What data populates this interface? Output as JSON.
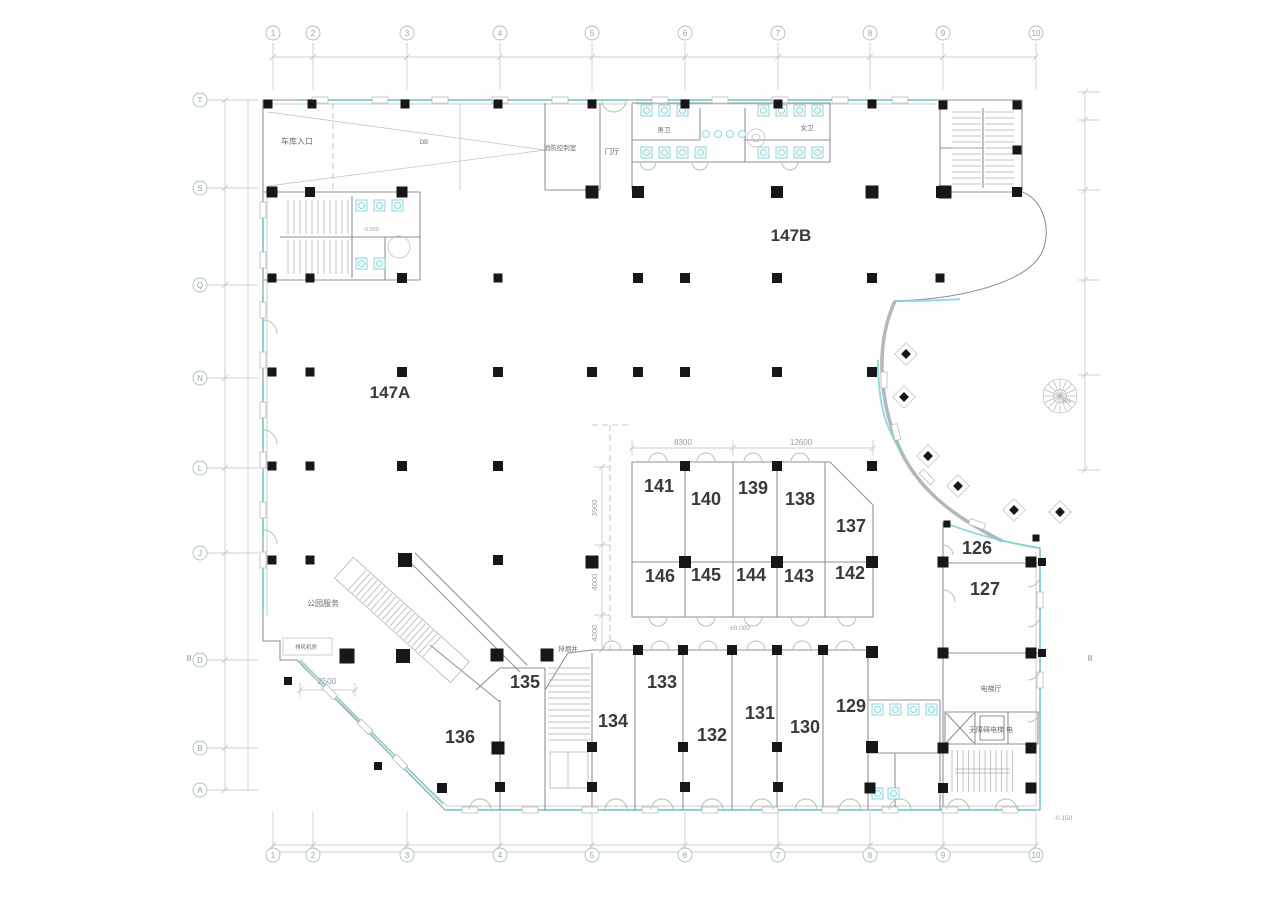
{
  "colors": {
    "glazing": "#85d3d6",
    "door_arc": "#abccab",
    "column": "#17171a",
    "wall": "#8e939a",
    "dim": "#9aa1a7",
    "room_text": "#3a3a3e",
    "label_text": "#6b6f73",
    "grid_text": "#8fa79a"
  },
  "halls": [
    {
      "label": "147A",
      "x": 390,
      "y": 398
    },
    {
      "label": "147B",
      "x": 791,
      "y": 241
    }
  ],
  "rooms": [
    {
      "label": "141",
      "x": 659,
      "y": 492
    },
    {
      "label": "140",
      "x": 706,
      "y": 505
    },
    {
      "label": "139",
      "x": 753,
      "y": 494
    },
    {
      "label": "138",
      "x": 800,
      "y": 505
    },
    {
      "label": "137",
      "x": 851,
      "y": 532
    },
    {
      "label": "146",
      "x": 660,
      "y": 582
    },
    {
      "label": "145",
      "x": 706,
      "y": 581
    },
    {
      "label": "144",
      "x": 751,
      "y": 581
    },
    {
      "label": "143",
      "x": 799,
      "y": 582
    },
    {
      "label": "142",
      "x": 850,
      "y": 579
    },
    {
      "label": "126",
      "x": 977,
      "y": 554
    },
    {
      "label": "127",
      "x": 985,
      "y": 595
    },
    {
      "label": "136",
      "x": 460,
      "y": 743
    },
    {
      "label": "135",
      "x": 525,
      "y": 688
    },
    {
      "label": "134",
      "x": 613,
      "y": 727
    },
    {
      "label": "133",
      "x": 662,
      "y": 688
    },
    {
      "label": "132",
      "x": 712,
      "y": 741
    },
    {
      "label": "131",
      "x": 760,
      "y": 719
    },
    {
      "label": "130",
      "x": 805,
      "y": 733
    },
    {
      "label": "129",
      "x": 851,
      "y": 712
    }
  ],
  "labels": [
    {
      "text": "车库入口",
      "x": 297,
      "y": 144,
      "s": 8
    },
    {
      "text": "DB",
      "x": 424,
      "y": 144,
      "s": 6
    },
    {
      "text": "消防控制室",
      "x": 560,
      "y": 150,
      "s": 6.5
    },
    {
      "text": "门厅",
      "x": 612,
      "y": 154,
      "s": 7.5
    },
    {
      "text": "男卫",
      "x": 664,
      "y": 132,
      "s": 6.5
    },
    {
      "text": "女卫",
      "x": 807,
      "y": 130,
      "s": 6.5
    },
    {
      "text": "公园服务",
      "x": 323,
      "y": 606,
      "s": 8
    },
    {
      "text": "排风机房",
      "x": 306,
      "y": 649,
      "s": 5.5
    },
    {
      "text": "排烟井",
      "x": 568,
      "y": 651,
      "s": 6.5
    },
    {
      "text": "电梯厅",
      "x": 991,
      "y": 691,
      "s": 7
    },
    {
      "text": "无障碍电梯 电",
      "x": 991,
      "y": 732,
      "s": 7
    }
  ],
  "dimensions": [
    {
      "text": "8300",
      "x": 683,
      "y": 445,
      "s": 8
    },
    {
      "text": "12600",
      "x": 801,
      "y": 445,
      "s": 8
    },
    {
      "text": "3900",
      "x": 597,
      "y": 508,
      "s": 7.5,
      "r": -90
    },
    {
      "text": "4000",
      "x": 597,
      "y": 582,
      "s": 7.5,
      "r": -90
    },
    {
      "text": "4200",
      "x": 597,
      "y": 633,
      "s": 7.5,
      "r": -90
    },
    {
      "text": "2500",
      "x": 327,
      "y": 684,
      "s": 8.5
    }
  ],
  "elevations": [
    {
      "text": "±0.000",
      "x": 740,
      "y": 630,
      "s": 6.5
    },
    {
      "text": "-0.150",
      "x": 1063,
      "y": 820,
      "s": 6.5
    },
    {
      "text": "-0.030",
      "x": 371,
      "y": 231,
      "s": 5.5
    },
    {
      "text": "5%",
      "x": 1067,
      "y": 403,
      "s": 6
    }
  ],
  "section_markers": [
    {
      "text": "II",
      "x": 189,
      "y": 661
    },
    {
      "text": "II",
      "x": 1090,
      "y": 661
    }
  ],
  "grid": {
    "top": {
      "labels": [
        "1",
        "2",
        "3",
        "4",
        "5",
        "6",
        "7",
        "8",
        "9",
        "10"
      ]
    },
    "bottom": {
      "labels": [
        "1",
        "2",
        "3",
        "4",
        "5",
        "6",
        "7",
        "8",
        "9",
        "10"
      ]
    },
    "left": {
      "labels": [
        "T",
        "S",
        "Q",
        "N",
        "L",
        "J",
        "D",
        "B",
        "A"
      ]
    }
  }
}
